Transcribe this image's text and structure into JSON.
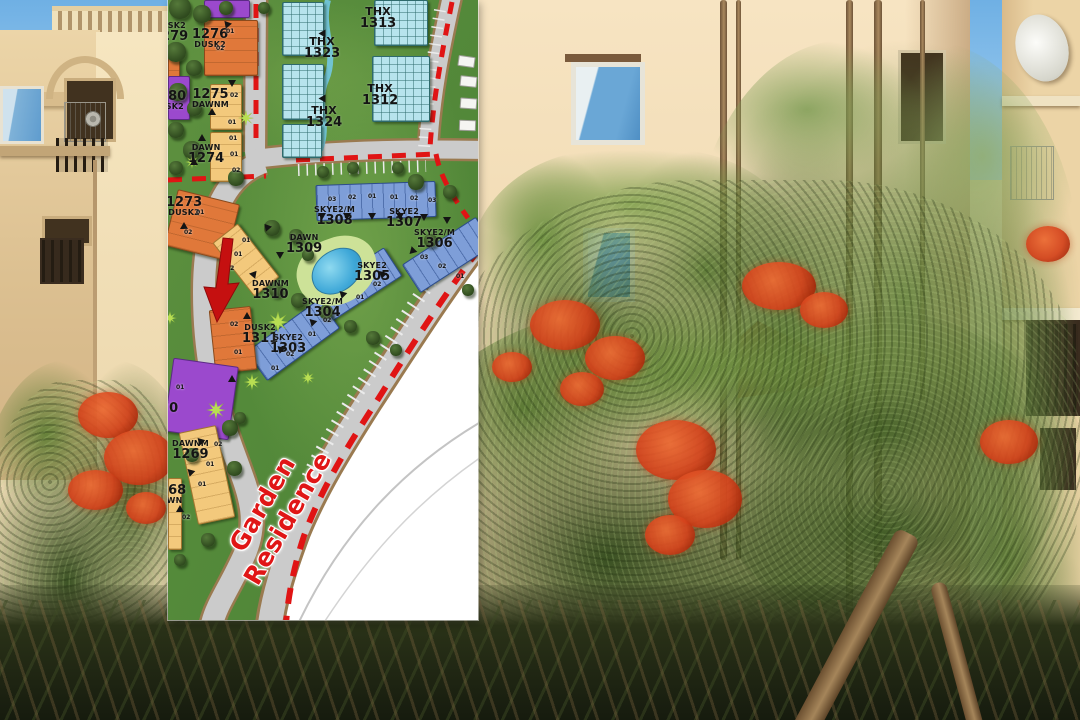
{
  "map": {
    "road_name": "Garden Residence",
    "labels": {
      "b1279": {
        "name": "DUSK2",
        "num": "1279"
      },
      "b1276": {
        "num": "1276",
        "name": "DUSK2"
      },
      "b1280": {
        "num": "1280",
        "name": "DUSK2"
      },
      "b1275": {
        "num": "1275",
        "name": "DAWNM"
      },
      "b1274": {
        "name": "DAWN",
        "num": "1274"
      },
      "thx1313": {
        "name": "THX",
        "num": "1313"
      },
      "thx1323": {
        "name": "THX",
        "num": "1323"
      },
      "thx1312": {
        "name": "THX",
        "num": "1312"
      },
      "thx1324": {
        "name": "THX",
        "num": "1324"
      },
      "b1273": {
        "num": "1273",
        "name": "DUSK2"
      },
      "b1308": {
        "name": "SKYE2/M",
        "num": "1308"
      },
      "b1307": {
        "name": "SKYE2",
        "num": "1307"
      },
      "b1309": {
        "name": "DAWN",
        "num": "1309"
      },
      "b1310": {
        "name": "DAWNM",
        "num": "1310"
      },
      "b1306": {
        "name": "SKYE2/M",
        "num": "1306"
      },
      "b1305": {
        "name": "SKYE2",
        "num": "1305"
      },
      "b1304": {
        "name": "SKYE2/M",
        "num": "1304"
      },
      "b1311": {
        "name": "DUSK2",
        "num": "1311"
      },
      "b1303": {
        "name": "SKYE2",
        "num": "1303"
      },
      "b1269": {
        "name": "DAWNM",
        "num": "1269"
      },
      "b1268": {
        "num": "1268",
        "name": "DAWN"
      },
      "b1270": {
        "num": "1270"
      }
    },
    "unit_markers": [
      {
        "x": 58,
        "y": 29,
        "t": "01"
      },
      {
        "x": 48,
        "y": 46,
        "t": "02"
      },
      {
        "x": 62,
        "y": 93,
        "t": "02"
      },
      {
        "x": 60,
        "y": 120,
        "t": "01"
      },
      {
        "x": 61,
        "y": 136,
        "t": "01"
      },
      {
        "x": 62,
        "y": 152,
        "t": "01"
      },
      {
        "x": 64,
        "y": 168,
        "t": "02"
      },
      {
        "x": 28,
        "y": 210,
        "t": "01"
      },
      {
        "x": 16,
        "y": 230,
        "t": "02"
      },
      {
        "x": 74,
        "y": 238,
        "t": "01"
      },
      {
        "x": 66,
        "y": 252,
        "t": "01"
      },
      {
        "x": 58,
        "y": 266,
        "t": "02"
      },
      {
        "x": 160,
        "y": 197,
        "t": "03"
      },
      {
        "x": 180,
        "y": 195,
        "t": "02"
      },
      {
        "x": 200,
        "y": 194,
        "t": "01"
      },
      {
        "x": 222,
        "y": 195,
        "t": "01"
      },
      {
        "x": 242,
        "y": 196,
        "t": "02"
      },
      {
        "x": 260,
        "y": 198,
        "t": "03"
      },
      {
        "x": 252,
        "y": 255,
        "t": "03"
      },
      {
        "x": 270,
        "y": 264,
        "t": "02"
      },
      {
        "x": 288,
        "y": 274,
        "t": "01"
      },
      {
        "x": 205,
        "y": 282,
        "t": "02"
      },
      {
        "x": 188,
        "y": 295,
        "t": "01"
      },
      {
        "x": 155,
        "y": 318,
        "t": "02"
      },
      {
        "x": 140,
        "y": 332,
        "t": "01"
      },
      {
        "x": 118,
        "y": 352,
        "t": "02"
      },
      {
        "x": 103,
        "y": 366,
        "t": "01"
      },
      {
        "x": 62,
        "y": 322,
        "t": "02"
      },
      {
        "x": 66,
        "y": 350,
        "t": "01"
      },
      {
        "x": 46,
        "y": 442,
        "t": "02"
      },
      {
        "x": 38,
        "y": 462,
        "t": "01"
      },
      {
        "x": 30,
        "y": 482,
        "t": "01"
      },
      {
        "x": 14,
        "y": 515,
        "t": "02"
      },
      {
        "x": 8,
        "y": 385,
        "t": "01"
      }
    ],
    "entrance_markers": [
      {
        "x": 30,
        "y": 134,
        "r": 0
      },
      {
        "x": 22,
        "y": 158,
        "r": 0
      },
      {
        "x": 12,
        "y": 222,
        "r": 0
      },
      {
        "x": 95,
        "y": 225,
        "r": 200
      },
      {
        "x": 108,
        "y": 252,
        "r": 180
      },
      {
        "x": 82,
        "y": 272,
        "r": 160
      },
      {
        "x": 150,
        "y": 213,
        "r": 180
      },
      {
        "x": 175,
        "y": 213,
        "r": 180
      },
      {
        "x": 200,
        "y": 213,
        "r": 180
      },
      {
        "x": 228,
        "y": 213,
        "r": 180
      },
      {
        "x": 252,
        "y": 214,
        "r": 180
      },
      {
        "x": 275,
        "y": 217,
        "r": 180
      },
      {
        "x": 240,
        "y": 248,
        "r": 225
      },
      {
        "x": 210,
        "y": 270,
        "r": 315
      },
      {
        "x": 170,
        "y": 290,
        "r": 315
      },
      {
        "x": 140,
        "y": 318,
        "r": 315
      },
      {
        "x": 108,
        "y": 345,
        "r": 315
      },
      {
        "x": 75,
        "y": 312,
        "r": 0
      },
      {
        "x": 60,
        "y": 375,
        "r": 0
      },
      {
        "x": 28,
        "y": 437,
        "r": 315
      },
      {
        "x": 18,
        "y": 468,
        "r": 315
      },
      {
        "x": 8,
        "y": 505,
        "r": 0
      },
      {
        "x": 55,
        "y": 22,
        "r": 200
      },
      {
        "x": 60,
        "y": 80,
        "r": 180
      },
      {
        "x": 40,
        "y": 108,
        "r": 0
      },
      {
        "x": 150,
        "y": 30,
        "r": 270
      },
      {
        "x": 150,
        "y": 95,
        "r": 270
      }
    ],
    "trees": [
      {
        "x": 12,
        "y": 8,
        "s": 22,
        "k": "dark"
      },
      {
        "x": 34,
        "y": 14,
        "s": 18,
        "k": "dark"
      },
      {
        "x": 58,
        "y": 8,
        "s": 14,
        "k": "dark"
      },
      {
        "x": 96,
        "y": 8,
        "s": 12,
        "k": "dark"
      },
      {
        "x": 8,
        "y": 52,
        "s": 20,
        "k": "dark"
      },
      {
        "x": 26,
        "y": 68,
        "s": 16,
        "k": "dark"
      },
      {
        "x": 10,
        "y": 92,
        "s": 18,
        "k": "dark"
      },
      {
        "x": 26,
        "y": 108,
        "s": 15,
        "k": "dark"
      },
      {
        "x": 8,
        "y": 130,
        "s": 16,
        "k": "dark"
      },
      {
        "x": 24,
        "y": 150,
        "s": 18,
        "k": "dark"
      },
      {
        "x": 8,
        "y": 168,
        "s": 14,
        "k": "dark"
      },
      {
        "x": 68,
        "y": 178,
        "s": 16,
        "k": "dark"
      },
      {
        "x": 104,
        "y": 228,
        "s": 16,
        "k": "dark"
      },
      {
        "x": 128,
        "y": 236,
        "s": 14,
        "k": "dark"
      },
      {
        "x": 140,
        "y": 255,
        "s": 12,
        "k": "dark"
      },
      {
        "x": 108,
        "y": 290,
        "s": 14,
        "k": "dark"
      },
      {
        "x": 130,
        "y": 300,
        "s": 15,
        "k": "dark"
      },
      {
        "x": 158,
        "y": 312,
        "s": 14,
        "k": "dark"
      },
      {
        "x": 182,
        "y": 326,
        "s": 13,
        "k": "dark"
      },
      {
        "x": 205,
        "y": 338,
        "s": 14,
        "k": "dark"
      },
      {
        "x": 228,
        "y": 350,
        "s": 12,
        "k": "dark"
      },
      {
        "x": 248,
        "y": 182,
        "s": 16,
        "k": "dark"
      },
      {
        "x": 282,
        "y": 192,
        "s": 14,
        "k": "dark"
      },
      {
        "x": 262,
        "y": 240,
        "s": 13,
        "k": "dark"
      },
      {
        "x": 300,
        "y": 290,
        "s": 12,
        "k": "dark"
      },
      {
        "x": 155,
        "y": 172,
        "s": 12,
        "k": "dark"
      },
      {
        "x": 185,
        "y": 168,
        "s": 12,
        "k": "dark"
      },
      {
        "x": 230,
        "y": 168,
        "s": 12,
        "k": "dark"
      },
      {
        "x": 62,
        "y": 428,
        "s": 16,
        "k": "dark"
      },
      {
        "x": 24,
        "y": 455,
        "s": 14,
        "k": "dark"
      },
      {
        "x": 66,
        "y": 468,
        "s": 15,
        "k": "dark"
      },
      {
        "x": 40,
        "y": 540,
        "s": 14,
        "k": "dark"
      },
      {
        "x": 12,
        "y": 560,
        "s": 12,
        "k": "dark"
      },
      {
        "x": 72,
        "y": 418,
        "s": 12,
        "k": "dark"
      },
      {
        "x": 78,
        "y": 118,
        "s": 16,
        "k": "palm"
      },
      {
        "x": 24,
        "y": 162,
        "s": 14,
        "k": "palm"
      },
      {
        "x": 110,
        "y": 322,
        "s": 22,
        "k": "palm"
      },
      {
        "x": 48,
        "y": 410,
        "s": 20,
        "k": "palm"
      },
      {
        "x": 84,
        "y": 382,
        "s": 17,
        "k": "palm"
      },
      {
        "x": 140,
        "y": 378,
        "s": 14,
        "k": "palm"
      },
      {
        "x": 2,
        "y": 318,
        "s": 14,
        "k": "palm"
      }
    ],
    "colors": {
      "grass_green": "#568b3a",
      "road_gray": "#cbcbcb",
      "road_edge_brown": "#9a7a50",
      "boundary_red": "#e01414",
      "dusk_orange": "#e0783a",
      "dawn_tan": "#f3c97c",
      "purple": "#9b49cd",
      "skye_blue": "#7e9ed8",
      "thx_cyan": "#b7e4ed",
      "pool_blue": "#3fa8d8",
      "arrow_red": "#c51010",
      "road_text_red": "#e01616"
    }
  },
  "photo": {
    "scene": "apartment buildings with flame trees",
    "sky_blue": "#7db8e8",
    "wall_beige": "#f2deb8",
    "flower_red": "#d5431c"
  }
}
